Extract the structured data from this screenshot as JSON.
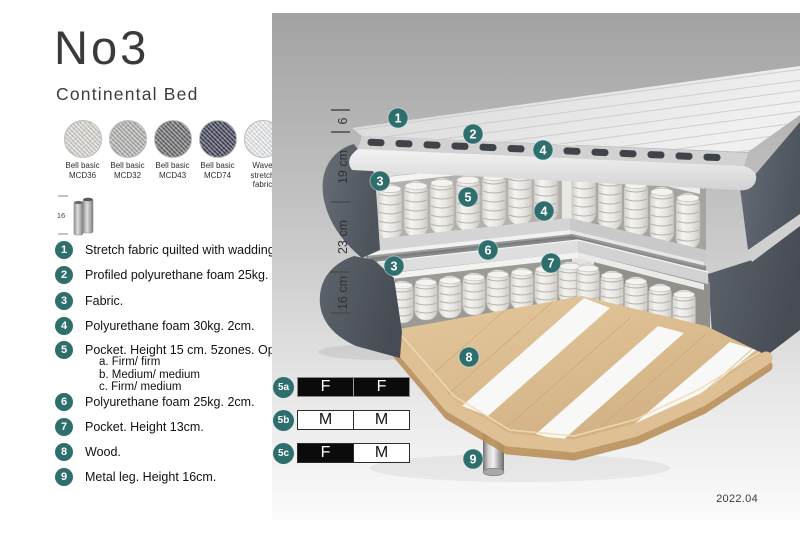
{
  "title": "No3",
  "subtitle": "Continental Bed",
  "swatches": [
    {
      "line1": "Bell basic",
      "line2": "MCD36",
      "color": "#d8d6d0"
    },
    {
      "line1": "Bell basic",
      "line2": "MCD32",
      "color": "#b0afad"
    },
    {
      "line1": "Bell basic",
      "line2": "MCD43",
      "color": "#68676a"
    },
    {
      "line1": "Bell basic",
      "line2": "MCD74",
      "color": "#3b3e54"
    },
    {
      "line1": "Wave",
      "line2": "stretch fabric",
      "color": "#eceef0"
    }
  ],
  "leg_icon": {
    "dimension": "16"
  },
  "legend": [
    {
      "num": "1",
      "text": "Stretch fabric quilted with wadding."
    },
    {
      "num": "2",
      "text": "Profiled polyurethane foam 25kg. 4cm."
    },
    {
      "num": "3",
      "text": "Fabric."
    },
    {
      "num": "4",
      "text": "Polyurethane foam 30kg. 2cm."
    },
    {
      "num": "5",
      "text": "Pocket. Height 15 cm. 5zones. Option:",
      "options": [
        "a. Firm/ firm",
        "b. Medium/ medium",
        "c. Firm/ medium"
      ]
    },
    {
      "num": "6",
      "text": "Polyurethane foam 25kg. 2cm."
    },
    {
      "num": "7",
      "text": "Pocket. Height 13cm."
    },
    {
      "num": "8",
      "text": "Wood."
    },
    {
      "num": "9",
      "text": "Metal leg. Height 16cm."
    }
  ],
  "diagram": {
    "callouts": [
      "1",
      "2",
      "4",
      "3",
      "5",
      "4",
      "6",
      "7",
      "3",
      "8",
      "9"
    ],
    "dimensions": [
      "6",
      "19 cm",
      "23 cm",
      "16 cm"
    ],
    "version": "2022.04"
  },
  "firmness": {
    "rows": [
      {
        "label": "5a",
        "left": "F",
        "right": "F"
      },
      {
        "label": "5b",
        "left": "M",
        "right": "M"
      },
      {
        "label": "5c",
        "left": "F",
        "right": "M"
      }
    ]
  },
  "colors": {
    "accent_teal": "#2e6f6e",
    "fabric_dark": "#596069",
    "wood": "#dcc096",
    "panel_top": "#a2a2a2",
    "panel_bottom": "#fbfbfb"
  }
}
